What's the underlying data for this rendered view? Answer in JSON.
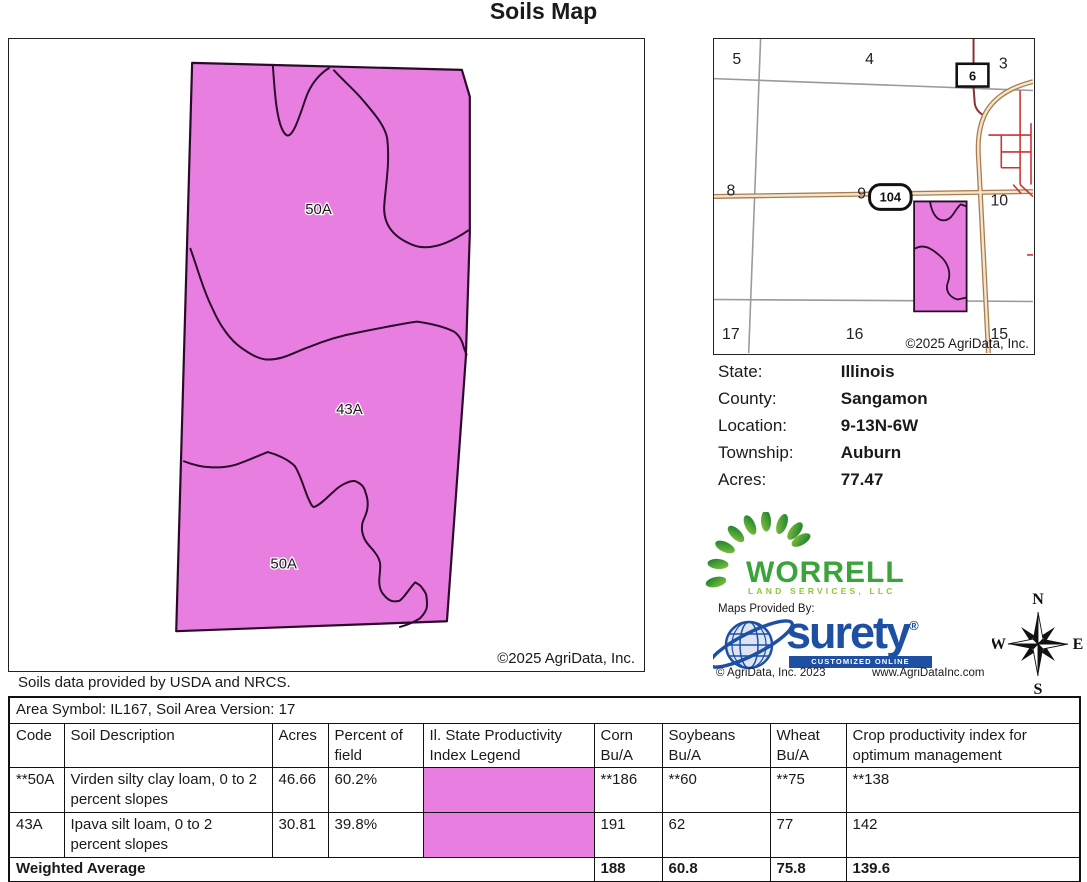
{
  "title": "Soils Map",
  "colors": {
    "soil_pink": "#E87EE0",
    "boundary_dark": "#2A0A2A",
    "surety_blue": "#1D4FA3",
    "worrell_green": "#3AA43A",
    "worrell_light_green": "#8CC63F",
    "road_tan": "#A97C50",
    "street_red": "#CC3333",
    "section_gray": "#9A9A9A"
  },
  "main_map": {
    "label_top": "50A",
    "label_middle": "43A",
    "label_bottom": "50A",
    "copyright": "©2025 AgriData, Inc.",
    "footnote": "Soils data provided by USDA and NRCS."
  },
  "locator_map": {
    "sections": [
      "5",
      "4",
      "3",
      "8",
      "9",
      "10",
      "17",
      "16",
      "15"
    ],
    "route_box_label": "6",
    "highway_badge_label": "104",
    "copyright": "©2025 AgriData, Inc."
  },
  "info": {
    "rows": [
      {
        "label": "State:",
        "value": "Illinois"
      },
      {
        "label": "County:",
        "value": "Sangamon"
      },
      {
        "label": "Location:",
        "value": "9-13N-6W"
      },
      {
        "label": "Township:",
        "value": "Auburn"
      },
      {
        "label": "Acres:",
        "value": "77.47"
      }
    ]
  },
  "worrell": {
    "name": "WORRELL",
    "subtitle": "LAND SERVICES, LLC"
  },
  "surety": {
    "provided_by": "Maps Provided By:",
    "brand": "surety",
    "registered": "®",
    "tagline": "CUSTOMIZED ONLINE MAPPING",
    "copyright": "© AgriData, Inc. 2023",
    "website": "www.AgriDataInc.com"
  },
  "compass": {
    "north": "N",
    "south": "S",
    "east": "E",
    "west": "W"
  },
  "table": {
    "area_header": "Area Symbol: IL167, Soil Area Version: 17",
    "columns": [
      "Code",
      "Soil Description",
      "Acres",
      "Percent of field",
      "Il. State Productivity Index Legend",
      "Corn\nBu/A",
      "Soybeans\nBu/A",
      "Wheat\nBu/A",
      "Crop productivity index for optimum management"
    ],
    "rows": [
      {
        "code": "**50A",
        "description": "Virden silty clay loam, 0 to 2 percent slopes",
        "acres": "46.66",
        "percent": "60.2%",
        "corn": "**186",
        "soybeans": "**60",
        "wheat": "**75",
        "crop_index": "**138"
      },
      {
        "code": "43A",
        "description": "Ipava silt loam, 0 to 2 percent slopes",
        "acres": "30.81",
        "percent": "39.8%",
        "corn": "191",
        "soybeans": "62",
        "wheat": "77",
        "crop_index": "142"
      }
    ],
    "weighted_average": {
      "label": "Weighted Average",
      "corn": "188",
      "soybeans": "60.8",
      "wheat": "75.8",
      "crop_index": "139.6"
    }
  }
}
